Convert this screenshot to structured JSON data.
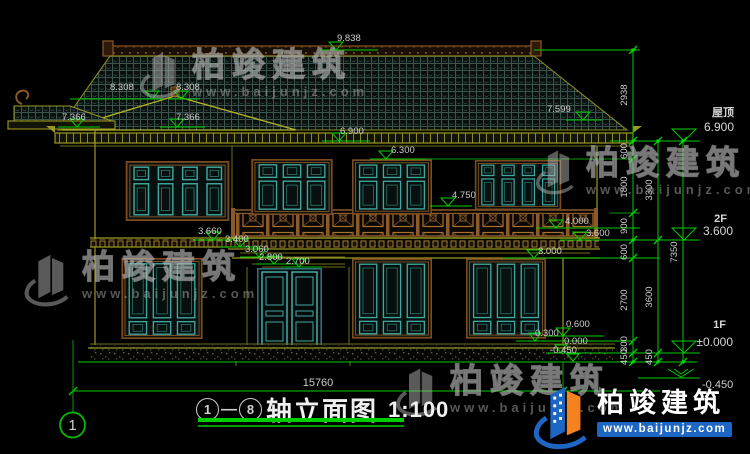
{
  "elevations": {
    "e9838": "9.838",
    "e8308a": "8.308",
    "e8308b": "8.308",
    "e7366a": "7.366",
    "e7366b": "7.366",
    "e7599": "7.599",
    "e6900": "6.900",
    "e6300": "6.300",
    "e4750": "4.750",
    "e4000": "4.000",
    "e3600": "3.600",
    "e3660": "3.660",
    "e3400": "3.400",
    "e3060": "3.060",
    "e3000": "3.000",
    "e2800": "2.800",
    "e2700": "2.700",
    "e0600": "0.600",
    "e0300": "0.300",
    "e0000": "0.000",
    "em450a": "-0.450"
  },
  "vertical_dims": {
    "d2938": "2938",
    "d600a": "600",
    "d1800": "1800",
    "d900": "900",
    "d600b": "600",
    "d2700": "2700",
    "d300": "300",
    "d450a": "450",
    "d3300": "3300",
    "d3600": "3600",
    "d450b": "450",
    "d7350": "7350"
  },
  "level_labels": {
    "roof_name": "屋顶",
    "roof_value": "6.900",
    "f2_name": "2F",
    "f2_value": "3.600",
    "f1_name": "1F",
    "f1_value": "±0.000",
    "ground": "-0.450"
  },
  "bottom": {
    "total_width": "15760",
    "axis_bubble": "1"
  },
  "title_block": {
    "axis_from": "1",
    "dash": "—",
    "axis_to": "8",
    "name": "轴立面图",
    "scale": "1:100"
  },
  "watermark": {
    "brand": "柏竣建筑",
    "site": "www.baijunjz.com"
  },
  "brand_footer": {
    "name": "柏竣建筑",
    "site": "www.baijunjz.com"
  },
  "colors": {
    "background": "#000000",
    "dim_green": "#00cc00",
    "text_gray": "#cdcdcd",
    "wall_olive": "#9a9a22",
    "frame_brown": "#7d4a1e",
    "lattice_teal": "#3fa89e",
    "title_white": "#f0f0f0",
    "brand_blue": "#1e66c4",
    "brand_orange": "#f5821f"
  }
}
